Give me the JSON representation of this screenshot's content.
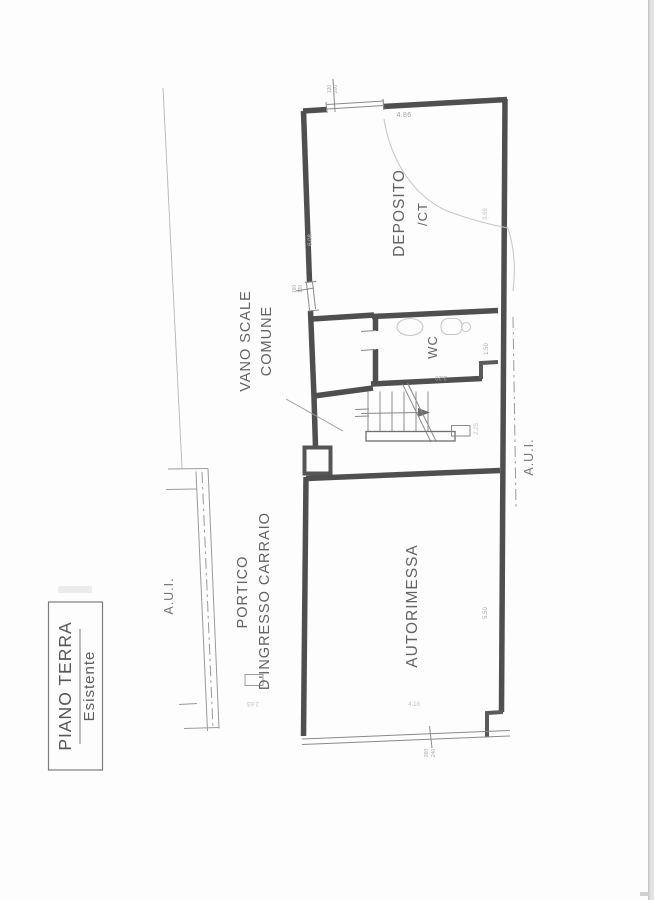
{
  "page": {
    "background": "#fdfdfd",
    "wall_color": "#4f4f4f",
    "thin_color": "#8a8a8a",
    "pencil_color": "#c8c8c8"
  },
  "title_block": {
    "line1": "PIANO TERRA",
    "line2": "Esistente"
  },
  "labels": {
    "aui_left": "A.U.I.",
    "aui_right": "A.U.I.",
    "vano_scale_line1": "VANO SCALE",
    "vano_scale_line2": "COMUNE",
    "portico_line1": "PORTICO",
    "portico_line2": "D'INGRESSO CARRAIO",
    "deposito_line1": "DEPOSITO",
    "deposito_line2": "/CT",
    "wc": "WC",
    "autorimessa": "AUTORIMESSA"
  },
  "dims": {
    "top_width": "4.86",
    "window_w": "120",
    "window_h": "200",
    "door_w": "160",
    "door_h": "120",
    "deposito_left": "6.08",
    "deposito_right": "3.69",
    "wc_w": "2.20",
    "wc_h": "1.50",
    "stair_w": "2.25",
    "garage_h": "5.50",
    "garage_w": "4.18",
    "garage_door_w": "260",
    "garage_door_h": "240",
    "road_w": "2.63"
  }
}
